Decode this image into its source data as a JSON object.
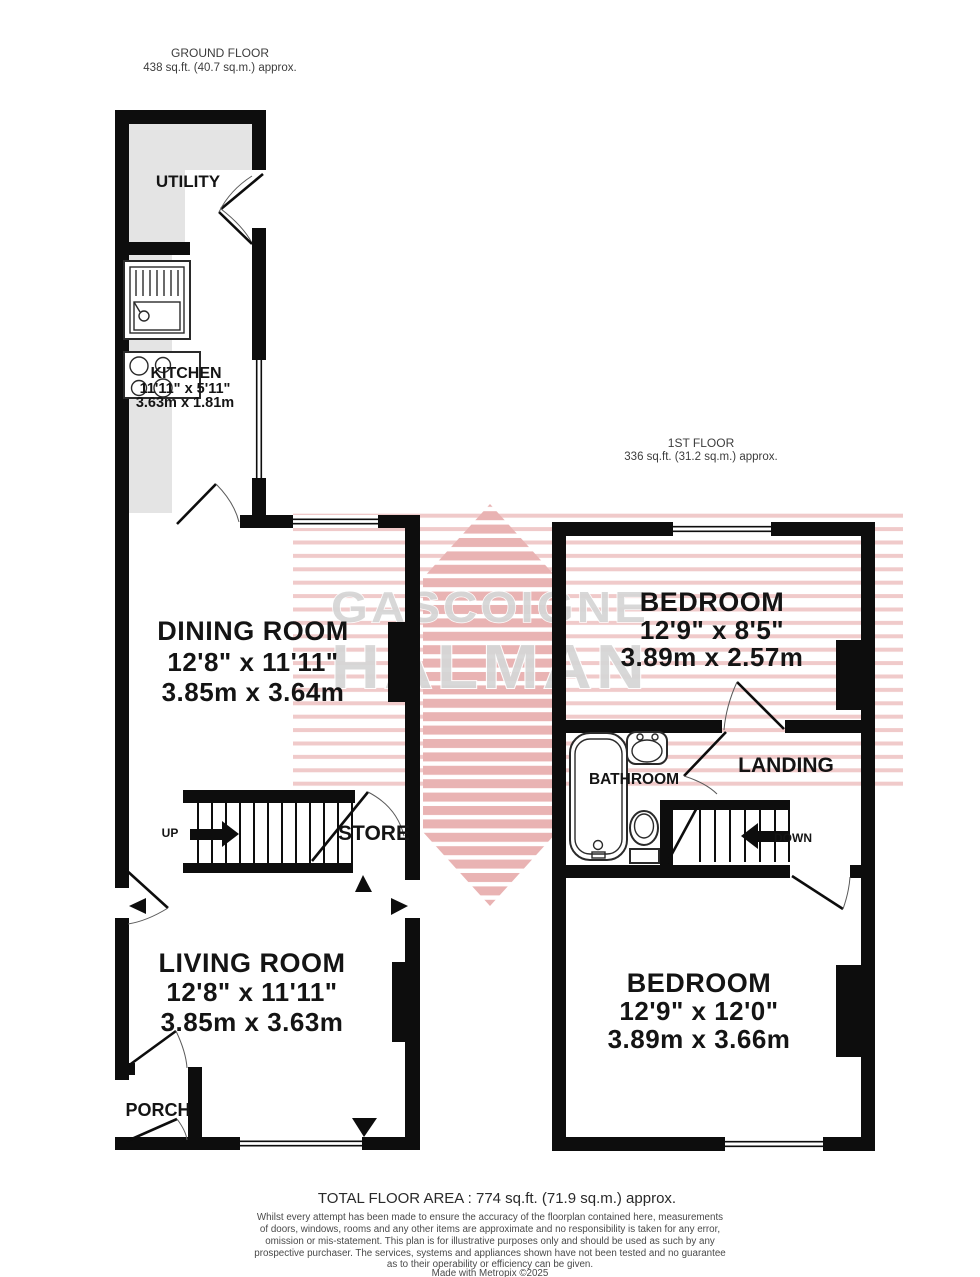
{
  "floors": {
    "ground": {
      "title": "GROUND FLOOR",
      "area": "438 sq.ft. (40.7 sq.m.) approx."
    },
    "first": {
      "title": "1ST FLOOR",
      "area": "336 sq.ft. (31.2 sq.m.) approx."
    }
  },
  "rooms": {
    "utility": {
      "name": "UTILITY"
    },
    "kitchen": {
      "name": "KITCHEN",
      "imperial": "11'11\" x 5'11\"",
      "metric": "3.63m x 1.81m"
    },
    "dining": {
      "name": "DINING ROOM",
      "imperial": "12'8\" x 11'11\"",
      "metric": "3.85m x 3.64m"
    },
    "store": {
      "name": "STORE"
    },
    "living": {
      "name": "LIVING ROOM",
      "imperial": "12'8\" x 11'11\"",
      "metric": "3.85m x 3.63m"
    },
    "porch": {
      "name": "PORCH"
    },
    "bedroom1": {
      "name": "BEDROOM",
      "imperial": "12'9\" x 8'5\"",
      "metric": "3.89m x 2.57m"
    },
    "bathroom": {
      "name": "BATHROOM"
    },
    "landing": {
      "name": "LANDING"
    },
    "bedroom2": {
      "name": "BEDROOM",
      "imperial": "12'9\" x 12'0\"",
      "metric": "3.89m x 3.66m"
    }
  },
  "stairs": {
    "up_label": "UP",
    "down_label": "DOWN"
  },
  "watermark": {
    "brand_top": "GASCOIGNE",
    "brand_bottom": "HALMAN"
  },
  "footer": {
    "total_area": "TOTAL FLOOR AREA : 774 sq.ft. (71.9 sq.m.) approx.",
    "disclaimer": [
      "Whilst every attempt has been made to ensure the accuracy of the floorplan contained here, measurements",
      "of doors, windows, rooms and any other items are approximate and no responsibility is taken for any error,",
      "omission or mis-statement. This plan is for illustrative purposes only and should be used as such by any",
      "prospective purchaser. The services, systems and appliances shown have not been tested and no guarantee",
      "as to their operability or efficiency can be given.",
      "Made with Metropix ©2025"
    ]
  },
  "colors": {
    "wall": "#0d0d0d",
    "floor_gray": "#e4e4e4",
    "stripe_pink": "#f0caca",
    "diamond_pink": "#e9b3b3",
    "brand_gray": "#d6d6d6"
  }
}
